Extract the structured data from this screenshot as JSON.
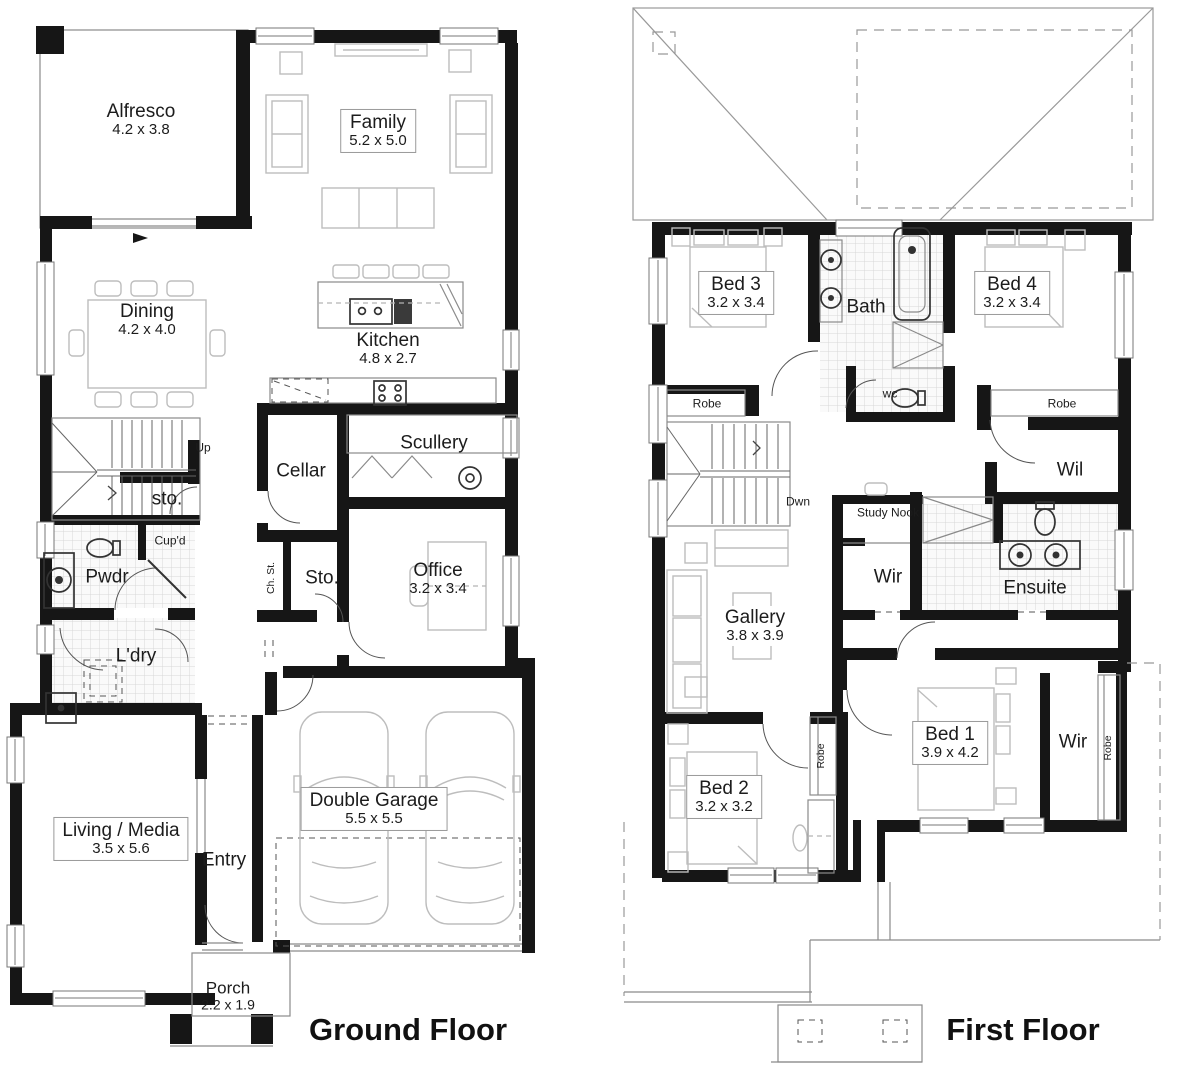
{
  "ground_floor": {
    "title": "Ground Floor",
    "rooms": {
      "alfresco": {
        "name": "Alfresco",
        "dims": "4.2 x 3.8"
      },
      "family": {
        "name": "Family",
        "dims": "5.2 x 5.0"
      },
      "dining": {
        "name": "Dining",
        "dims": "4.2 x 4.0"
      },
      "kitchen": {
        "name": "Kitchen",
        "dims": "4.8 x 2.7"
      },
      "scullery": {
        "name": "Scullery"
      },
      "cellar": {
        "name": "Cellar"
      },
      "stair_up": {
        "name": "Up"
      },
      "store_under_stairs": {
        "name": "sto."
      },
      "cupboard": {
        "name": "Cup'd"
      },
      "powder": {
        "name": "Pwdr"
      },
      "chute_store": {
        "name": "Ch. St."
      },
      "store": {
        "name": "Sto."
      },
      "office": {
        "name": "Office",
        "dims": "3.2 x 3.4"
      },
      "laundry": {
        "name": "L'dry"
      },
      "living_media": {
        "name": "Living / Media",
        "dims": "3.5 x 5.6"
      },
      "entry": {
        "name": "Entry"
      },
      "double_garage": {
        "name": "Double Garage",
        "dims": "5.5 x 5.5"
      },
      "porch": {
        "name": "Porch",
        "dims": "2.2 x 1.9"
      }
    }
  },
  "first_floor": {
    "title": "First Floor",
    "rooms": {
      "bed3": {
        "name": "Bed 3",
        "dims": "3.2 x 3.4"
      },
      "bath": {
        "name": "Bath"
      },
      "bed4": {
        "name": "Bed 4",
        "dims": "3.2 x 3.4"
      },
      "robe_bed3": {
        "name": "Robe"
      },
      "wc": {
        "name": "wc"
      },
      "robe_bed4": {
        "name": "Robe"
      },
      "stair_down": {
        "name": "Dwn"
      },
      "walk_in_linen": {
        "name": "Wil"
      },
      "study_nook": {
        "name": "Study Nook"
      },
      "wir_hall": {
        "name": "Wir"
      },
      "ensuite": {
        "name": "Ensuite"
      },
      "gallery": {
        "name": "Gallery",
        "dims": "3.8 x 3.9"
      },
      "bed2": {
        "name": "Bed 2",
        "dims": "3.2 x 3.2"
      },
      "robe_bed2": {
        "name": "Robe"
      },
      "bed1": {
        "name": "Bed 1",
        "dims": "3.9 x 4.2"
      },
      "wir_bed1": {
        "name": "Wir"
      },
      "robe_wir": {
        "name": "Robe"
      }
    }
  },
  "colors": {
    "wall": "#161616",
    "furniture": "#bdbdbd",
    "fixture": "#333333",
    "text": "#1c1c1c",
    "tile_line": "#d8d8d8"
  }
}
